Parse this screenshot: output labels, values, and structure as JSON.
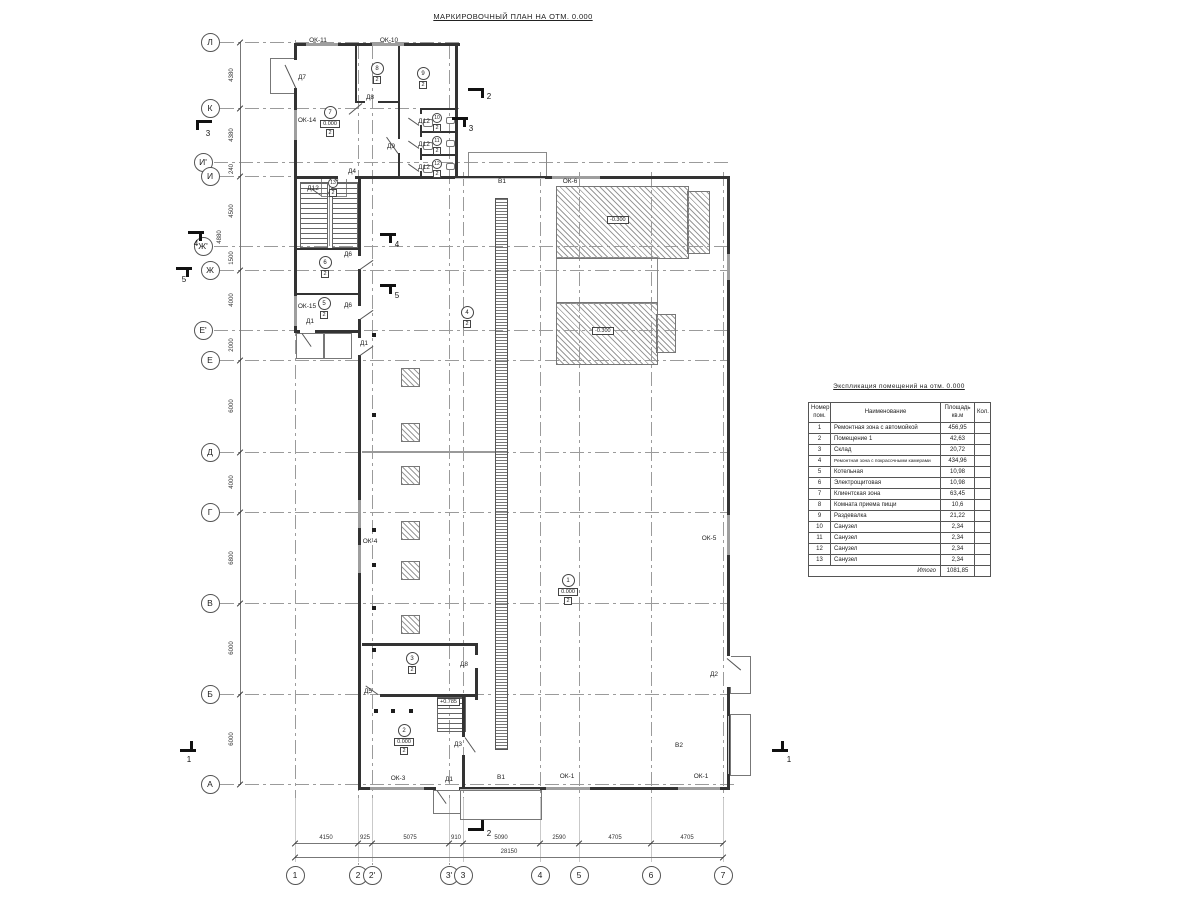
{
  "plan_title": "МАРКИРОВОЧНЫЙ ПЛАН НА ОТМ. 0.000",
  "plan": {
    "walls": [
      [
        294,
        43,
        166,
        3
      ],
      [
        294,
        43,
        3,
        290
      ],
      [
        455,
        43,
        3,
        136
      ],
      [
        294,
        176,
        66,
        3
      ],
      [
        358,
        176,
        372,
        3
      ],
      [
        727,
        176,
        3,
        614
      ],
      [
        358,
        787,
        372,
        3
      ],
      [
        358,
        176,
        3,
        614
      ],
      [
        294,
        330,
        66,
        3
      ],
      [
        355,
        45,
        2,
        58
      ],
      [
        355,
        101,
        10,
        2
      ],
      [
        378,
        101,
        22,
        2
      ],
      [
        398,
        45,
        2,
        94
      ],
      [
        398,
        153,
        2,
        25
      ],
      [
        420,
        108,
        2,
        70
      ],
      [
        420,
        108,
        37,
        2
      ],
      [
        420,
        131,
        37,
        2
      ],
      [
        420,
        154,
        37,
        2
      ],
      [
        294,
        248,
        66,
        2
      ],
      [
        294,
        293,
        66,
        2
      ],
      [
        362,
        643,
        116,
        3
      ],
      [
        475,
        643,
        3,
        12
      ],
      [
        475,
        668,
        3,
        32
      ],
      [
        437,
        694,
        41,
        3
      ],
      [
        380,
        694,
        58,
        3
      ],
      [
        462,
        697,
        3,
        40
      ],
      [
        462,
        755,
        3,
        35
      ]
    ],
    "windows": [
      [
        306,
        43,
        32,
        3
      ],
      [
        372,
        43,
        32,
        3
      ],
      [
        294,
        110,
        3,
        30
      ],
      [
        294,
        296,
        3,
        30
      ],
      [
        552,
        176,
        48,
        3
      ],
      [
        358,
        500,
        3,
        28
      ],
      [
        358,
        545,
        3,
        28
      ],
      [
        727,
        254,
        3,
        26
      ],
      [
        727,
        515,
        3,
        40
      ],
      [
        370,
        787,
        54,
        3
      ],
      [
        546,
        787,
        44,
        3
      ],
      [
        678,
        787,
        42,
        3
      ]
    ],
    "gates": [
      [
        455,
        177.5,
        90,
        1.5
      ],
      [
        460,
        788.5,
        80,
        1.5
      ],
      [
        727.5,
        716,
        1.5,
        58
      ]
    ],
    "gaps": [
      [
        293,
        60,
        5,
        28
      ],
      [
        357,
        256,
        5,
        13
      ],
      [
        357,
        306,
        5,
        13
      ],
      [
        357,
        338,
        5,
        17
      ],
      [
        338,
        176,
        17,
        3
      ],
      [
        419,
        114,
        4,
        11
      ],
      [
        419,
        137,
        4,
        11
      ],
      [
        419,
        160,
        4,
        11
      ],
      [
        300,
        330,
        15,
        3
      ],
      [
        436,
        787,
        23,
        3
      ],
      [
        726,
        656,
        5,
        31
      ]
    ],
    "thin": [
      [
        362,
        451,
        133,
        1.5
      ],
      [
        329,
        182,
        1,
        64
      ]
    ],
    "hatch": [
      [
        556,
        186,
        131,
        71
      ],
      [
        687,
        191,
        21,
        61
      ],
      [
        556,
        302,
        100,
        61
      ],
      [
        656,
        314,
        18,
        37
      ],
      [
        401,
        368,
        17,
        17
      ],
      [
        401,
        423,
        17,
        17
      ],
      [
        401,
        466,
        17,
        17
      ],
      [
        401,
        521,
        17,
        17
      ],
      [
        401,
        561,
        17,
        17
      ],
      [
        401,
        615,
        17,
        17
      ]
    ],
    "outlines": [
      [
        556,
        257,
        100,
        45
      ],
      [
        321,
        177,
        24,
        18
      ],
      [
        468,
        152,
        77,
        24
      ]
    ],
    "porches": [
      [
        270,
        58,
        24,
        34
      ],
      [
        296,
        333,
        26,
        24
      ],
      [
        324,
        333,
        26,
        24
      ],
      [
        433,
        790,
        26,
        22
      ],
      [
        460,
        790,
        80,
        28
      ],
      [
        730,
        656,
        19,
        36
      ],
      [
        730,
        714,
        19,
        60
      ]
    ],
    "trench": [
      495,
      198,
      11,
      550
    ],
    "stairs": [
      [
        300,
        182,
        26,
        64
      ],
      [
        332,
        182,
        24,
        64
      ],
      [
        437,
        697,
        27,
        33
      ]
    ],
    "dots": [
      [
        374,
        335
      ],
      [
        374,
        415
      ],
      [
        374,
        530
      ],
      [
        374,
        565
      ],
      [
        374,
        608
      ],
      [
        374,
        650
      ],
      [
        376,
        711
      ],
      [
        393,
        711
      ],
      [
        411,
        711
      ]
    ],
    "swings": [
      [
        296,
        88,
        26,
        -115
      ],
      [
        362,
        103,
        17,
        140
      ],
      [
        398,
        153,
        20,
        -125
      ],
      [
        338,
        179,
        19,
        125
      ],
      [
        419,
        125,
        13,
        -145
      ],
      [
        419,
        148,
        13,
        -145
      ],
      [
        419,
        171,
        13,
        -145
      ],
      [
        321,
        195,
        12,
        -145
      ],
      [
        360,
        269,
        16,
        -35
      ],
      [
        360,
        319,
        16,
        -35
      ],
      [
        360,
        355,
        16,
        -35
      ],
      [
        302,
        333,
        16,
        55
      ],
      [
        378,
        694,
        15,
        -145
      ],
      [
        465,
        737,
        18,
        55
      ],
      [
        727,
        658,
        18,
        40
      ],
      [
        437,
        790,
        16,
        55
      ]
    ],
    "fixtures": [
      [
        423,
        119,
        8,
        6
      ],
      [
        423,
        142,
        8,
        6
      ],
      [
        423,
        165,
        8,
        6
      ],
      [
        446,
        117,
        7,
        5
      ],
      [
        446,
        140,
        7,
        5
      ],
      [
        446,
        163,
        7,
        5
      ]
    ],
    "axis_rows": [
      [
        "Л",
        42,
        460
      ],
      [
        "К",
        108,
        460
      ],
      [
        "И'",
        162,
        730
      ],
      [
        "И",
        176,
        730
      ],
      [
        "Ж'",
        246,
        730
      ],
      [
        "Ж",
        270,
        730
      ],
      [
        "Е'",
        330,
        730
      ],
      [
        "Е",
        360,
        730
      ],
      [
        "Д",
        452,
        730
      ],
      [
        "Г",
        512,
        730
      ],
      [
        "В",
        603,
        730
      ],
      [
        "Б",
        694,
        730
      ],
      [
        "А",
        784,
        735
      ]
    ],
    "axis_cols": [
      [
        "1",
        295,
        40
      ],
      [
        "2",
        358,
        45
      ],
      [
        "2'",
        372,
        45
      ],
      [
        "3'",
        449,
        45
      ],
      [
        "3",
        463,
        172
      ],
      [
        "4",
        540,
        172
      ],
      [
        "5",
        579,
        172
      ],
      [
        "6",
        651,
        172
      ],
      [
        "7",
        723,
        172
      ]
    ],
    "dims_left": [
      [
        "4380",
        75
      ],
      [
        "4380",
        135
      ],
      [
        "240",
        169
      ],
      [
        "4500",
        211
      ],
      [
        "1500",
        258
      ],
      [
        "4000",
        300
      ],
      [
        "2000",
        345
      ],
      [
        "6000",
        406
      ],
      [
        "4000",
        482
      ],
      [
        "6800",
        558
      ],
      [
        "6000",
        648
      ],
      [
        "6000",
        739
      ]
    ],
    "dim_left_outer": [
      "4880",
      237
    ],
    "dims_bottom": [
      [
        "4150",
        326
      ],
      [
        "925",
        365
      ],
      [
        "5075",
        410
      ],
      [
        "910",
        456
      ],
      [
        "5090",
        501
      ],
      [
        "2590",
        559
      ],
      [
        "4705",
        615
      ],
      [
        "4705",
        687
      ]
    ],
    "dim_total": [
      "28150",
      509
    ],
    "rooms": [
      [
        "7",
        330,
        106,
        "0.000",
        "2",
        0
      ],
      [
        "8",
        377,
        62,
        "",
        "2",
        0
      ],
      [
        "9",
        423,
        67,
        "",
        "2",
        0
      ],
      [
        "10",
        437,
        113,
        "",
        "2",
        1
      ],
      [
        "11",
        437,
        136,
        "",
        "2",
        1
      ],
      [
        "12",
        437,
        159,
        "",
        "2",
        1
      ],
      [
        "13",
        333,
        178,
        "",
        "2",
        1
      ],
      [
        "6",
        325,
        256,
        "",
        "2",
        0
      ],
      [
        "5",
        324,
        297,
        "",
        "2",
        0
      ],
      [
        "4",
        467,
        306,
        "",
        "2",
        0
      ],
      [
        "1",
        568,
        574,
        "0.000",
        "2",
        0
      ],
      [
        "3",
        412,
        652,
        "",
        "2",
        0
      ],
      [
        "2",
        404,
        724,
        "0.000",
        "2",
        0
      ]
    ],
    "levels": [
      [
        "-0.300",
        621,
        216
      ],
      [
        "-0.300",
        606,
        327
      ],
      [
        "+0.785",
        451,
        698
      ]
    ],
    "labels": [
      [
        "ОК-11",
        318,
        40
      ],
      [
        "ОК-10",
        389,
        40
      ],
      [
        "Д7",
        302,
        77
      ],
      [
        "ОК-14",
        307,
        120
      ],
      [
        "Д8",
        370,
        97
      ],
      [
        "Д9",
        391,
        146
      ],
      [
        "Д4",
        352,
        171
      ],
      [
        "Д12",
        424,
        121
      ],
      [
        "Д12",
        424,
        144
      ],
      [
        "Д12",
        424,
        167
      ],
      [
        "Д12",
        313,
        188
      ],
      [
        "Д6",
        348,
        254
      ],
      [
        "Д6",
        348,
        305
      ],
      [
        "ОК-15",
        307,
        306
      ],
      [
        "Д1",
        310,
        321
      ],
      [
        "Д1",
        364,
        343
      ],
      [
        "В1",
        502,
        181
      ],
      [
        "ОК-6",
        570,
        181
      ],
      [
        "ОК-4",
        370,
        541
      ],
      [
        "ОК-5",
        709,
        538
      ],
      [
        "Д8",
        464,
        664
      ],
      [
        "Д5",
        368,
        691
      ],
      [
        "Д3",
        458,
        744
      ],
      [
        "Д2",
        714,
        674
      ],
      [
        "В2",
        679,
        745
      ],
      [
        "ОК-3",
        398,
        778
      ],
      [
        "Д1",
        449,
        779
      ],
      [
        "В1",
        501,
        777
      ],
      [
        "ОК-1",
        567,
        776
      ],
      [
        "ОК-1",
        701,
        776
      ]
    ],
    "markers": [
      [
        "2",
        468,
        88,
        481,
        90,
        484,
        92
      ],
      [
        "2",
        468,
        828,
        481,
        820,
        484,
        829
      ],
      [
        "3",
        196,
        120,
        196,
        122,
        203,
        129
      ],
      [
        "3",
        452,
        117,
        463,
        119,
        466,
        124
      ],
      [
        "4",
        188,
        231,
        199,
        233,
        191,
        239
      ],
      [
        "4",
        380,
        233,
        389,
        235,
        392,
        240
      ],
      [
        "5",
        176,
        267,
        186,
        269,
        179,
        275
      ],
      [
        "5",
        380,
        284,
        389,
        286,
        392,
        291
      ],
      [
        "1",
        180,
        749,
        190,
        741,
        184,
        755
      ],
      [
        "1",
        772,
        749,
        781,
        741,
        784,
        755
      ]
    ]
  },
  "table": {
    "title": "Экспликация помещений на отм. 0.000",
    "headers": [
      "Номер\nпом.",
      "Наименование",
      "Площадь\nкв.м",
      "Кол."
    ],
    "rows": [
      [
        "1",
        "Ремонтная зона с автомойкой",
        "456,95",
        ""
      ],
      [
        "2",
        "Помещение 1",
        "42,63",
        ""
      ],
      [
        "3",
        "Склад",
        "20,72",
        ""
      ],
      [
        "4",
        "Ремонтная зона с покрасочными камерами",
        "434,96",
        ""
      ],
      [
        "5",
        "Котельная",
        "10,98",
        ""
      ],
      [
        "6",
        "Электрощитовая",
        "10,98",
        ""
      ],
      [
        "7",
        "Клиентская зона",
        "63,45",
        ""
      ],
      [
        "8",
        "Комната приема пищи",
        "10,6",
        ""
      ],
      [
        "9",
        "Раздевалка",
        "21,22",
        ""
      ],
      [
        "10",
        "Санузел",
        "2,34",
        ""
      ],
      [
        "11",
        "Санузел",
        "2,34",
        ""
      ],
      [
        "12",
        "Санузел",
        "2,34",
        ""
      ],
      [
        "13",
        "Санузел",
        "2,34",
        ""
      ]
    ],
    "total_label": "Итого",
    "total_value": "1081,85"
  }
}
